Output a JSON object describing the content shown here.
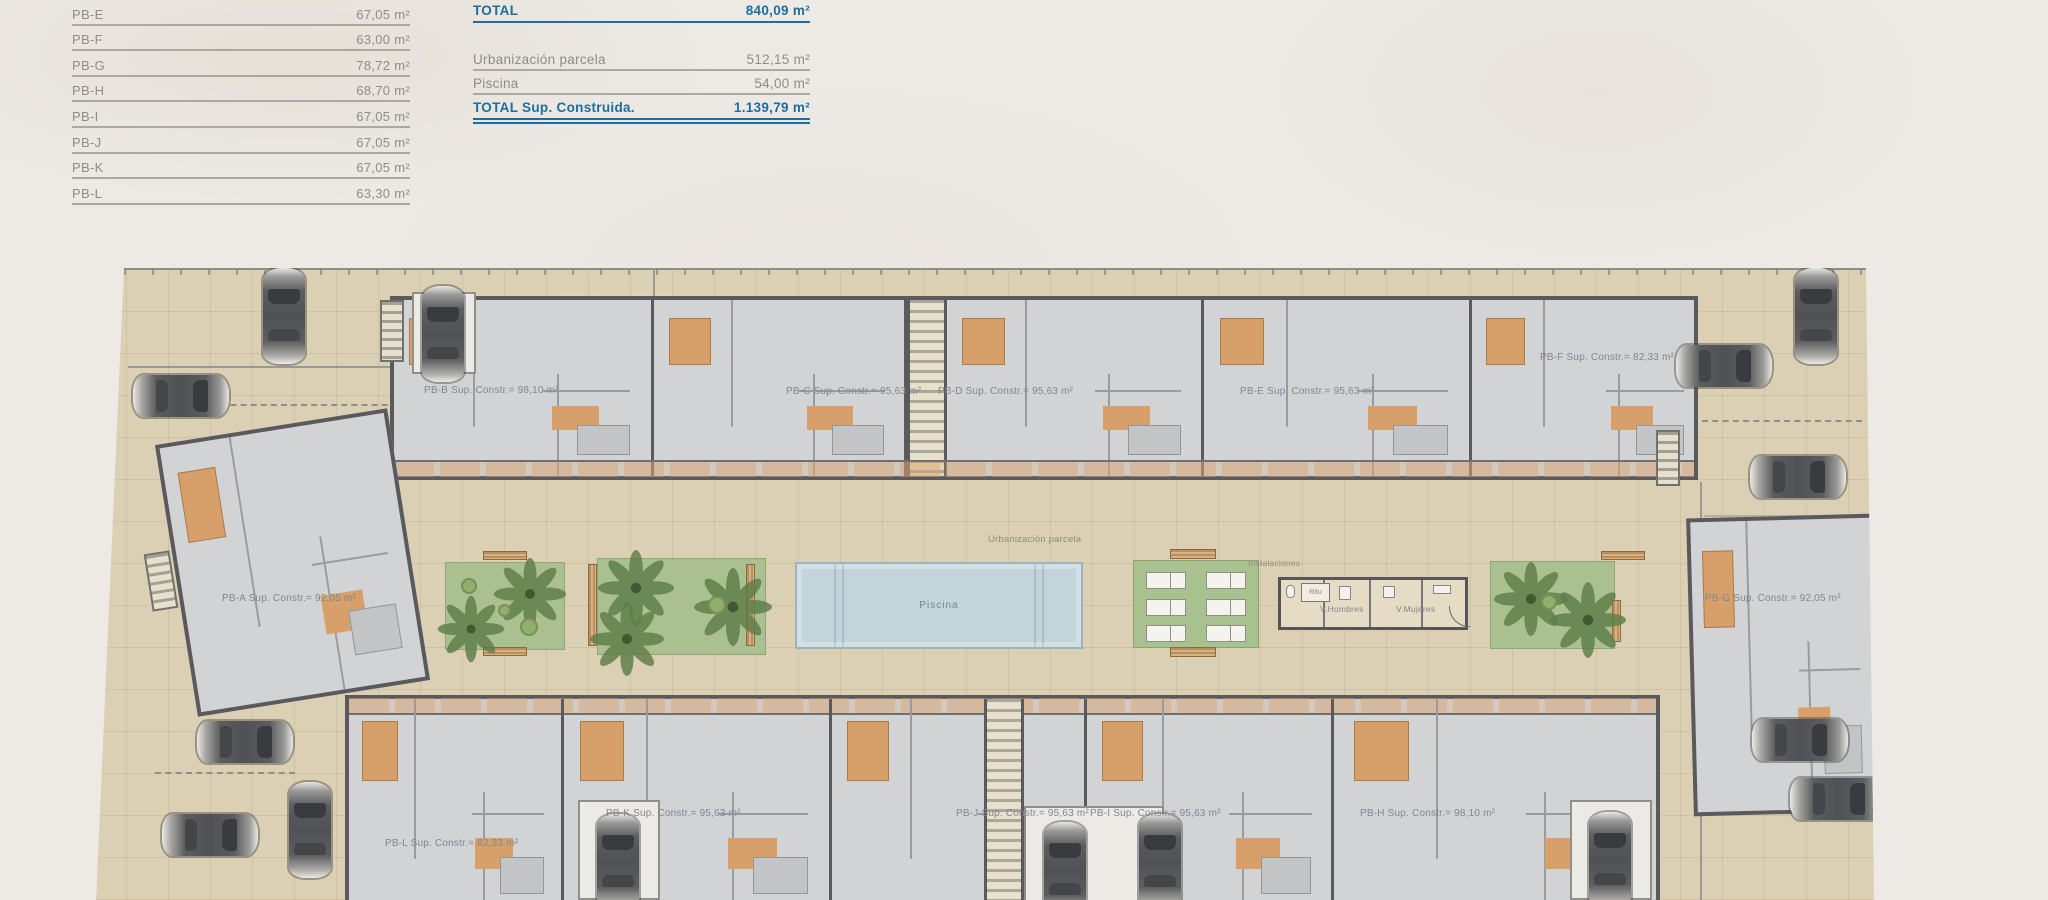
{
  "sheet": {
    "area_table": {
      "rows": [
        {
          "label": "PB-E",
          "value": "67,05 m²"
        },
        {
          "label": "PB-F",
          "value": "63,00 m²"
        },
        {
          "label": "PB-G",
          "value": "78,72 m²"
        },
        {
          "label": "PB-H",
          "value": "68,70 m²"
        },
        {
          "label": "PB-I",
          "value": "67,05 m²"
        },
        {
          "label": "PB-J",
          "value": "67,05 m²"
        },
        {
          "label": "PB-K",
          "value": "67,05 m²"
        },
        {
          "label": "PB-L",
          "value": "63,30 m²"
        }
      ]
    },
    "summary_table": {
      "total_label": "TOTAL",
      "total_value": "840,09 m²",
      "rows": [
        {
          "label": "Urbanización parcela",
          "value": "512,15 m²"
        },
        {
          "label": "Piscina",
          "value": "54,00 m²"
        }
      ],
      "grand_label": "TOTAL Sup. Construida.",
      "grand_value": "1.139,79 m²"
    },
    "plan": {
      "units": {
        "pb_a": "PB-A Sup. Constr.= 92,05 m²",
        "pb_b": "PB-B Sup. Constr.= 98,10 m²",
        "pb_c": "PB-C Sup. Constr.= 95,63 m²",
        "pb_d": "PB-D Sup. Constr.= 95,63 m²",
        "pb_e": "PB-E Sup. Constr.= 95,63 m²",
        "pb_f": "PB-F Sup. Constr.= 82,33 m²",
        "pb_g": "PB-G Sup. Constr.= 92,05 m²",
        "pb_h": "PB-H Sup. Constr.= 98,10 m²",
        "pb_i": "PB-I Sup. Constr.= 95,63 m²",
        "pb_j": "PB-J Sup. Constr.= 95,63 m²",
        "pb_k": "PB-K Sup. Constr.= 95,63 m²",
        "pb_l": "PB-L Sup. Constr.= 82,33 m²"
      },
      "labels": {
        "urbanizacion": "Urbanización parcela",
        "piscina": "Piscina",
        "instalaciones": "Instalaciones",
        "ritu": "Ritu",
        "v_hombres": "V.Hombres",
        "v_mujeres": "V.Mujeres"
      }
    },
    "colors": {
      "accent_blue": "#1d6d9e",
      "table_gray": "#8d8d89",
      "site_beige": "#dcd0b4",
      "pool_blue": "#c3d4db",
      "garden_green": "#aac091",
      "floor_gray": "#d2d3d5",
      "wall_gray": "#5a5a5e"
    }
  }
}
